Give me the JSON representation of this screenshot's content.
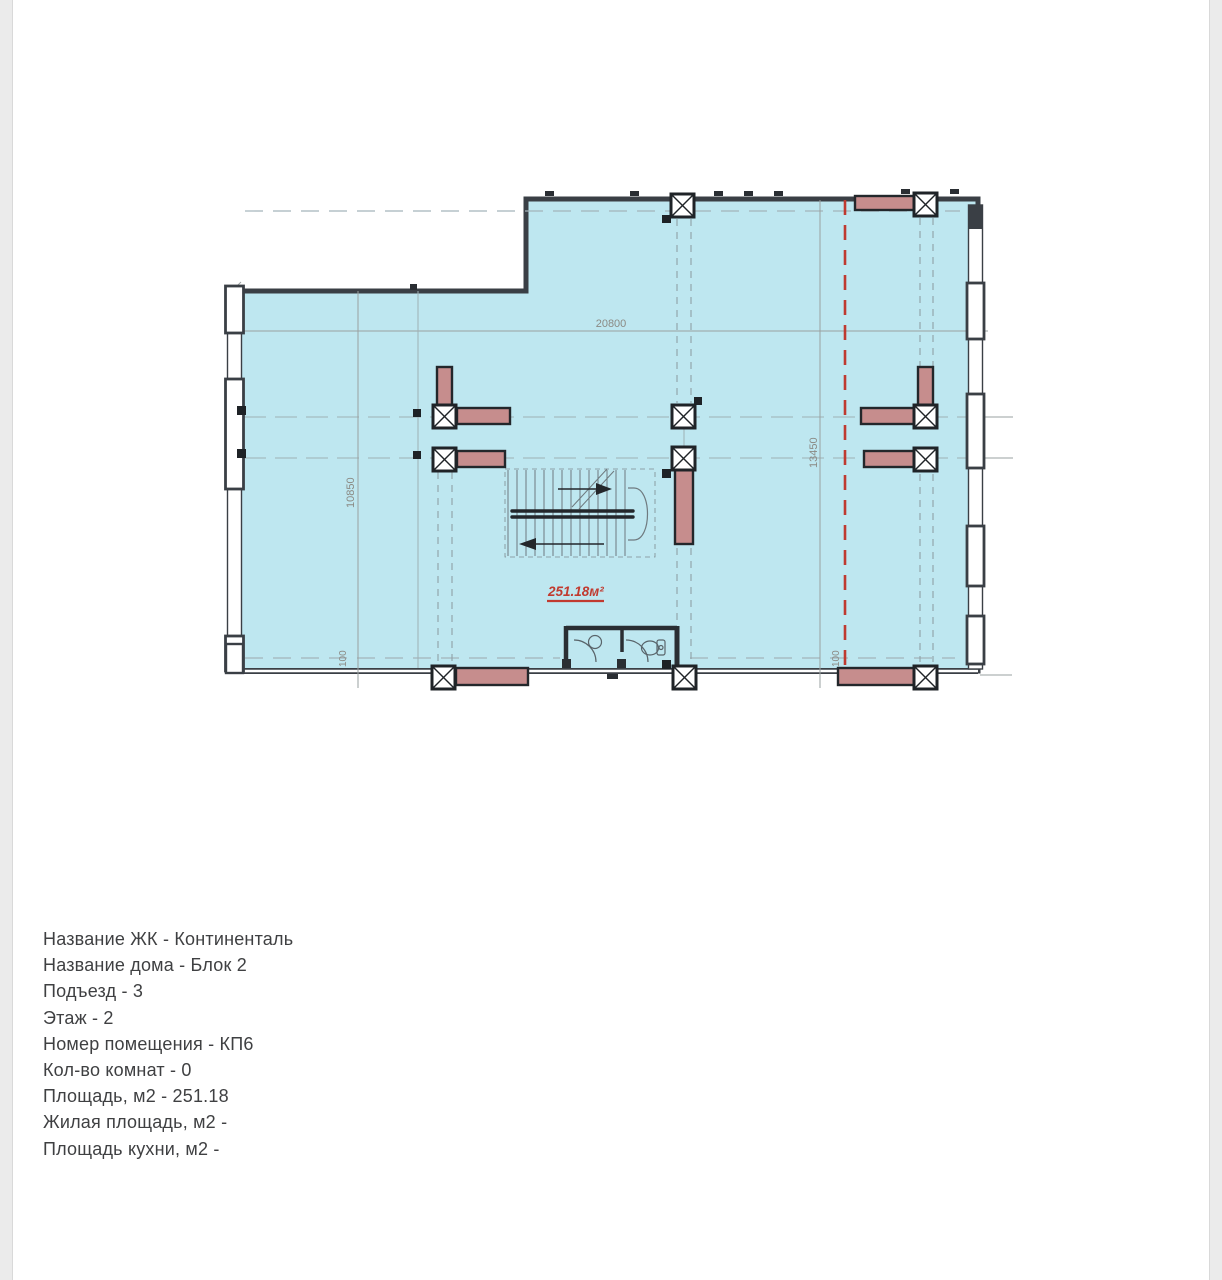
{
  "plan": {
    "area_label": "251.18м²",
    "dimensions": {
      "width_mm": "20800",
      "left_height_mm": "10850",
      "right_height_mm": "13450",
      "bottom_left_offset_mm": "100",
      "bottom_right_offset_mm": "100"
    },
    "colors": {
      "room_fill": "#bee7f0",
      "wall": "#3a3f45",
      "column_outline": "#1f2327",
      "column_wall_fill": "#c68d8d",
      "red_accent": "#bf3a30",
      "dimension_text": "#8b8a84"
    }
  },
  "info": {
    "lines": [
      {
        "text": "Название ЖК - Континенталь"
      },
      {
        "text": "Название дома - Блок 2"
      },
      {
        "text": "Подъезд - 3"
      },
      {
        "text": "Этаж - 2"
      },
      {
        "text": "Номер помещения - КП6"
      },
      {
        "text": "Кол-во комнат - 0"
      },
      {
        "text": "Площадь, м2 - 251.18"
      },
      {
        "text": "Жилая площадь, м2 -"
      },
      {
        "text": "Площадь кухни, м2 -"
      }
    ]
  }
}
